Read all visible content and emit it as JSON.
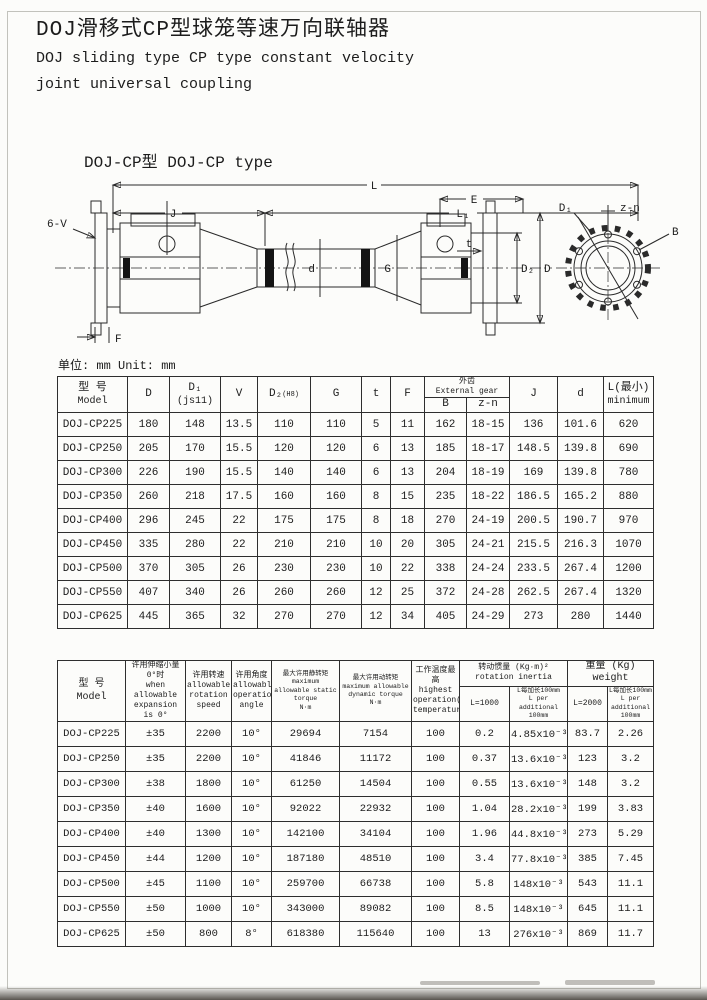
{
  "page": {
    "title_zh": "DOJ滑移式CP型球笼等速万向联轴器",
    "title_en_line1": "DOJ sliding type CP type constant velocity",
    "title_en_line2": "joint universal coupling",
    "subtitle": "DOJ-CP型 DOJ-CP type",
    "unit_note": "单位: mm Unit: mm"
  },
  "diagram": {
    "labels": {
      "l": "L",
      "j": "J",
      "l1": "L₁",
      "e": "E",
      "six_v": "6-V",
      "f": "F",
      "d_small": "d",
      "g": "G",
      "t": "t",
      "d2": "D₂",
      "d_cap": "D",
      "d1": "D₁",
      "zn": "z-n",
      "b": "B"
    }
  },
  "table1": {
    "headers": {
      "model_zh": "型 号",
      "model_en": "Model",
      "d": "D",
      "d1": "D₁",
      "d1_note": "(js11)",
      "v": "V",
      "d2": "D₂",
      "d2_note": "(H8)",
      "g": "G",
      "t": "t",
      "f": "F",
      "ext_gear_zh": "外齿",
      "ext_gear_en": "External gear",
      "b": "B",
      "zn": "z-n",
      "j": "J",
      "d_small": "d",
      "l_zh": "L(最小)",
      "l_en": "minimum"
    },
    "rows": [
      [
        "DOJ-CP225",
        "180",
        "148",
        "13.5",
        "110",
        "110",
        "5",
        "11",
        "162",
        "18-15",
        "136",
        "101.6",
        "620"
      ],
      [
        "DOJ-CP250",
        "205",
        "170",
        "15.5",
        "120",
        "120",
        "6",
        "13",
        "185",
        "18-17",
        "148.5",
        "139.8",
        "690"
      ],
      [
        "DOJ-CP300",
        "226",
        "190",
        "15.5",
        "140",
        "140",
        "6",
        "13",
        "204",
        "18-19",
        "169",
        "139.8",
        "780"
      ],
      [
        "DOJ-CP350",
        "260",
        "218",
        "17.5",
        "160",
        "160",
        "8",
        "15",
        "235",
        "18-22",
        "186.5",
        "165.2",
        "880"
      ],
      [
        "DOJ-CP400",
        "296",
        "245",
        "22",
        "175",
        "175",
        "8",
        "18",
        "270",
        "24-19",
        "200.5",
        "190.7",
        "970"
      ],
      [
        "DOJ-CP450",
        "335",
        "280",
        "22",
        "210",
        "210",
        "10",
        "20",
        "305",
        "24-21",
        "215.5",
        "216.3",
        "1070"
      ],
      [
        "DOJ-CP500",
        "370",
        "305",
        "26",
        "230",
        "230",
        "10",
        "22",
        "338",
        "24-24",
        "233.5",
        "267.4",
        "1200"
      ],
      [
        "DOJ-CP550",
        "407",
        "340",
        "26",
        "260",
        "260",
        "12",
        "25",
        "372",
        "24-28",
        "262.5",
        "267.4",
        "1320"
      ],
      [
        "DOJ-CP625",
        "445",
        "365",
        "32",
        "270",
        "270",
        "12",
        "34",
        "405",
        "24-29",
        "273",
        "280",
        "1440"
      ]
    ]
  },
  "table2": {
    "headers": {
      "model_zh": "型 号",
      "model_en": "Model",
      "expansion_zh": "许用伸缩小量0°时",
      "expansion_en": "when allowable expansion is 0°",
      "speed_zh": "许用转速",
      "speed_en": "allowable rotation speed",
      "angle_zh": "许用角度",
      "angle_en": "allowable operation angle",
      "static_zh": "最大许用静转矩",
      "static_en": "maximum allowable static torque",
      "static_unit": "N·m",
      "dynamic_zh": "最大许用动转矩",
      "dynamic_en": "maximum allowable dynamic torque",
      "dynamic_unit": "N·m",
      "temp_zh": "工作温度最高",
      "temp_en": "highest operation(C°) temperature",
      "inertia_zh": "转动惯量 (Kg·m)²",
      "inertia_en": "rotation inertia",
      "inertia_l": "L=1000",
      "per100_zh": "L每加长100mm",
      "per100_en": "L per additional 100mm",
      "weight_title": "重量 (Kg) weight",
      "weight_l": "L=2000"
    },
    "rows": [
      [
        "DOJ-CP225",
        "±35",
        "2200",
        "10°",
        "29694",
        "7154",
        "100",
        "0.2",
        "4.85x10⁻³",
        "83.7",
        "2.26"
      ],
      [
        "DOJ-CP250",
        "±35",
        "2200",
        "10°",
        "41846",
        "11172",
        "100",
        "0.37",
        "13.6x10⁻³",
        "123",
        "3.2"
      ],
      [
        "DOJ-CP300",
        "±38",
        "1800",
        "10°",
        "61250",
        "14504",
        "100",
        "0.55",
        "13.6x10⁻³",
        "148",
        "3.2"
      ],
      [
        "DOJ-CP350",
        "±40",
        "1600",
        "10°",
        "92022",
        "22932",
        "100",
        "1.04",
        "28.2x10⁻³",
        "199",
        "3.83"
      ],
      [
        "DOJ-CP400",
        "±40",
        "1300",
        "10°",
        "142100",
        "34104",
        "100",
        "1.96",
        "44.8x10⁻³",
        "273",
        "5.29"
      ],
      [
        "DOJ-CP450",
        "±44",
        "1200",
        "10°",
        "187180",
        "48510",
        "100",
        "3.4",
        "77.8x10⁻³",
        "385",
        "7.45"
      ],
      [
        "DOJ-CP500",
        "±45",
        "1100",
        "10°",
        "259700",
        "66738",
        "100",
        "5.8",
        "148x10⁻³",
        "543",
        "11.1"
      ],
      [
        "DOJ-CP550",
        "±50",
        "1000",
        "10°",
        "343000",
        "89082",
        "100",
        "8.5",
        "148x10⁻³",
        "645",
        "11.1"
      ],
      [
        "DOJ-CP625",
        "±50",
        "800",
        "8°",
        "618380",
        "115640",
        "100",
        "13",
        "276x10⁻³",
        "869",
        "11.7"
      ]
    ]
  }
}
